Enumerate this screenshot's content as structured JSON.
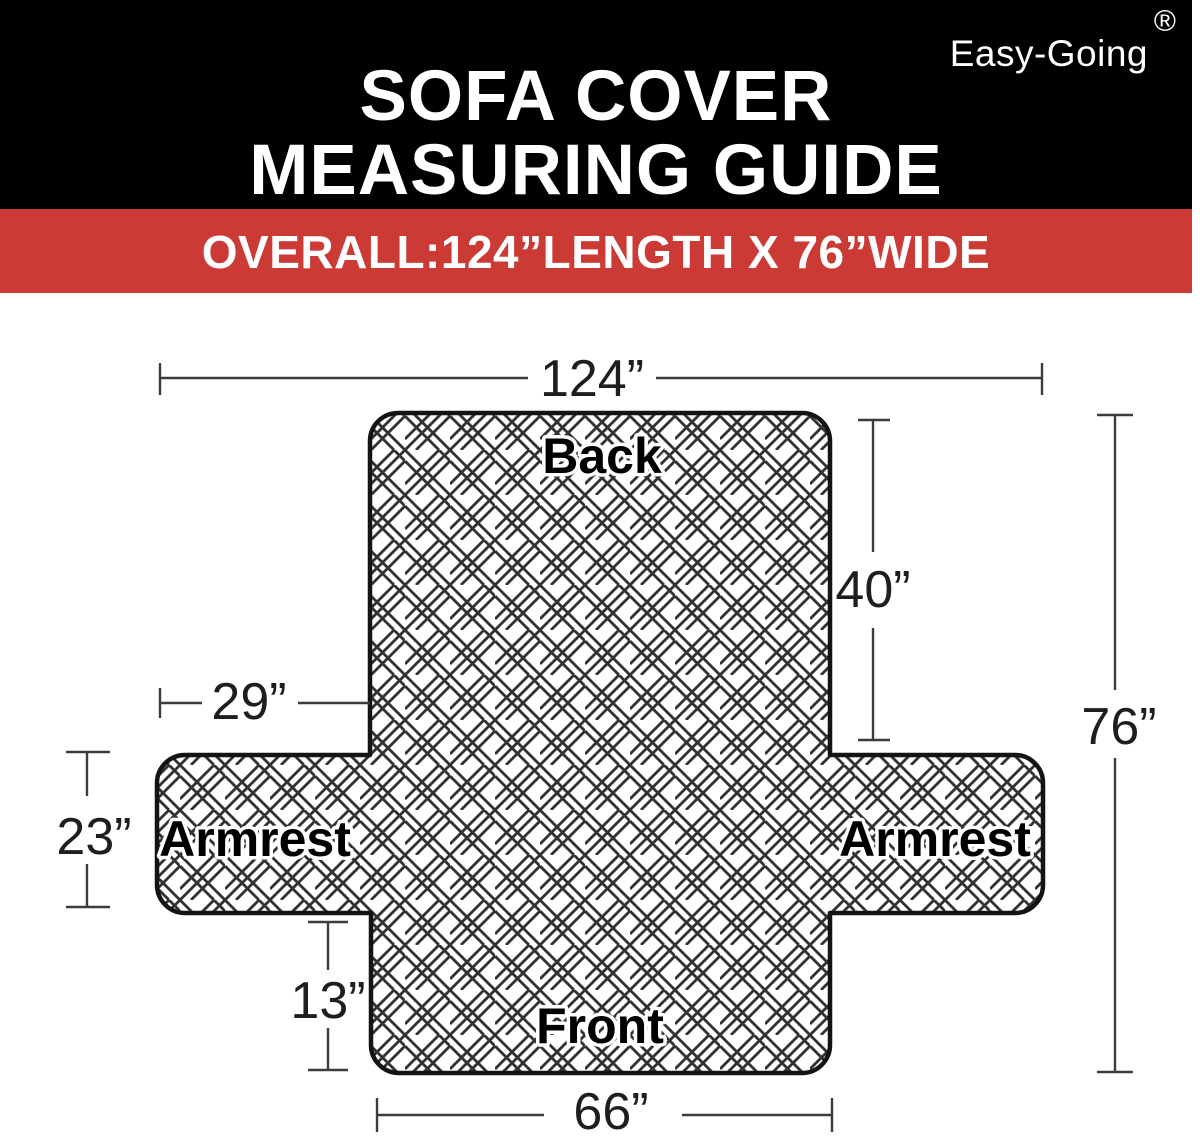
{
  "colors": {
    "header_bg": "#000000",
    "banner_bg": "#cb3a34",
    "text_light": "#ffffff",
    "outline": "#141414",
    "lattice": "#323232",
    "line": "#3c3c3c",
    "label": "#000000"
  },
  "brand": {
    "name": "Easy-Going",
    "registered": "®"
  },
  "header": {
    "title_line1": "SOFA COVER",
    "title_line2": "MEASURING GUIDE"
  },
  "banner": {
    "text": "OVERALL:124”LENGTH X 76”WIDE"
  },
  "diagram": {
    "sections": {
      "back": "Back",
      "armrest_left": "Armrest",
      "armrest_right": "Armrest",
      "front": "Front"
    },
    "dims": {
      "overall_length": "124”",
      "back_depth": "29”",
      "armrest_height": "23”",
      "back_height": "40”",
      "overall_width": "76”",
      "front_skirt_height": "13”",
      "front_width": "66”"
    }
  }
}
